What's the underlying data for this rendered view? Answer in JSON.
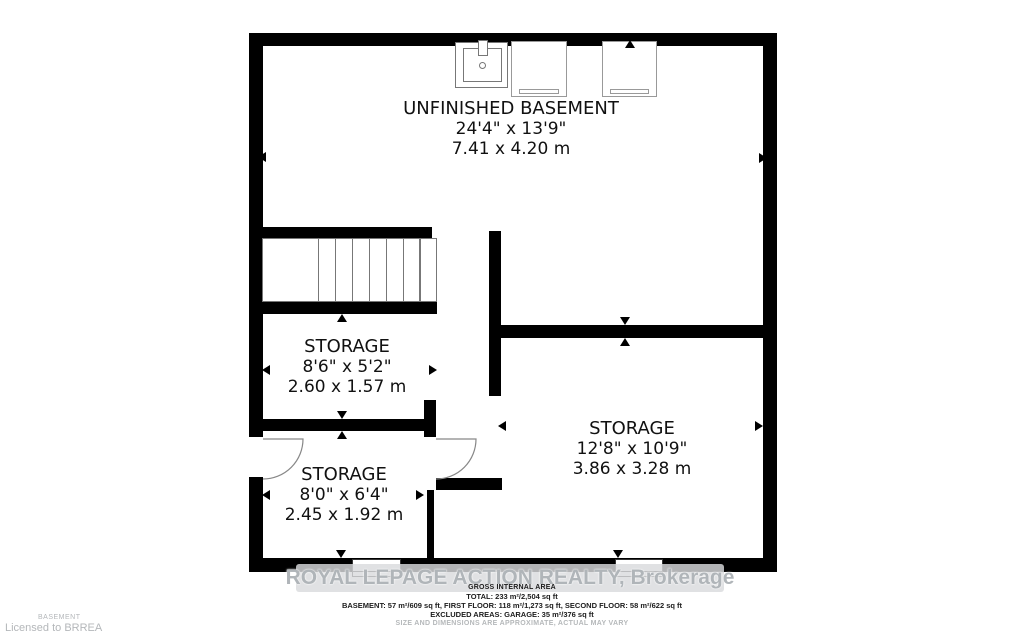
{
  "plan": {
    "title_room": "UNFINISHED BASEMENT",
    "rooms": [
      {
        "name": "UNFINISHED BASEMENT",
        "dimensions_imperial": "24'4\" x 13'9\"",
        "dimensions_metric": "7.41 x 4.20 m"
      },
      {
        "name": "STORAGE",
        "dimensions_imperial": "8'6\" x 5'2\"",
        "dimensions_metric": "2.60 x 1.57 m"
      },
      {
        "name": "STORAGE",
        "dimensions_imperial": "8'0\" x 6'4\"",
        "dimensions_metric": "2.45 x 1.92 m"
      },
      {
        "name": "STORAGE",
        "dimensions_imperial": "12'8\" x 10'9\"",
        "dimensions_metric": "3.86 x 3.28 m"
      }
    ],
    "fixtures": [
      "laundry-sink",
      "appliance",
      "appliance"
    ],
    "features": [
      "staircase",
      "door-left-exterior",
      "door-interior",
      "window-left",
      "window-right"
    ]
  },
  "watermark": {
    "text": "ROYAL LEPAGE ACTION REALTY, Brokerage"
  },
  "footer": {
    "heading": "GROSS INTERNAL AREA",
    "total": "TOTAL: 233 m²/2,504 sq ft",
    "floors": "BASEMENT: 57 m²/609 sq ft, FIRST FLOOR: 118 m²/1,273 sq ft, SECOND FLOOR: 58 m²/622 sq ft",
    "excluded": "EXCLUDED AREAS: GARAGE: 35 m²/376 sq ft",
    "disclaimer": "SIZE AND DIMENSIONS ARE APPROXIMATE, ACTUAL MAY VARY"
  },
  "license": {
    "floor_label": "BASEMENT",
    "licensed_to": "Licensed to BRREA"
  },
  "colors": {
    "wall": "#000000",
    "fixture_line": "#777777",
    "door_line": "#888888",
    "watermark_text": "#b0b5b9",
    "muted_text": "#b4b7ba"
  }
}
